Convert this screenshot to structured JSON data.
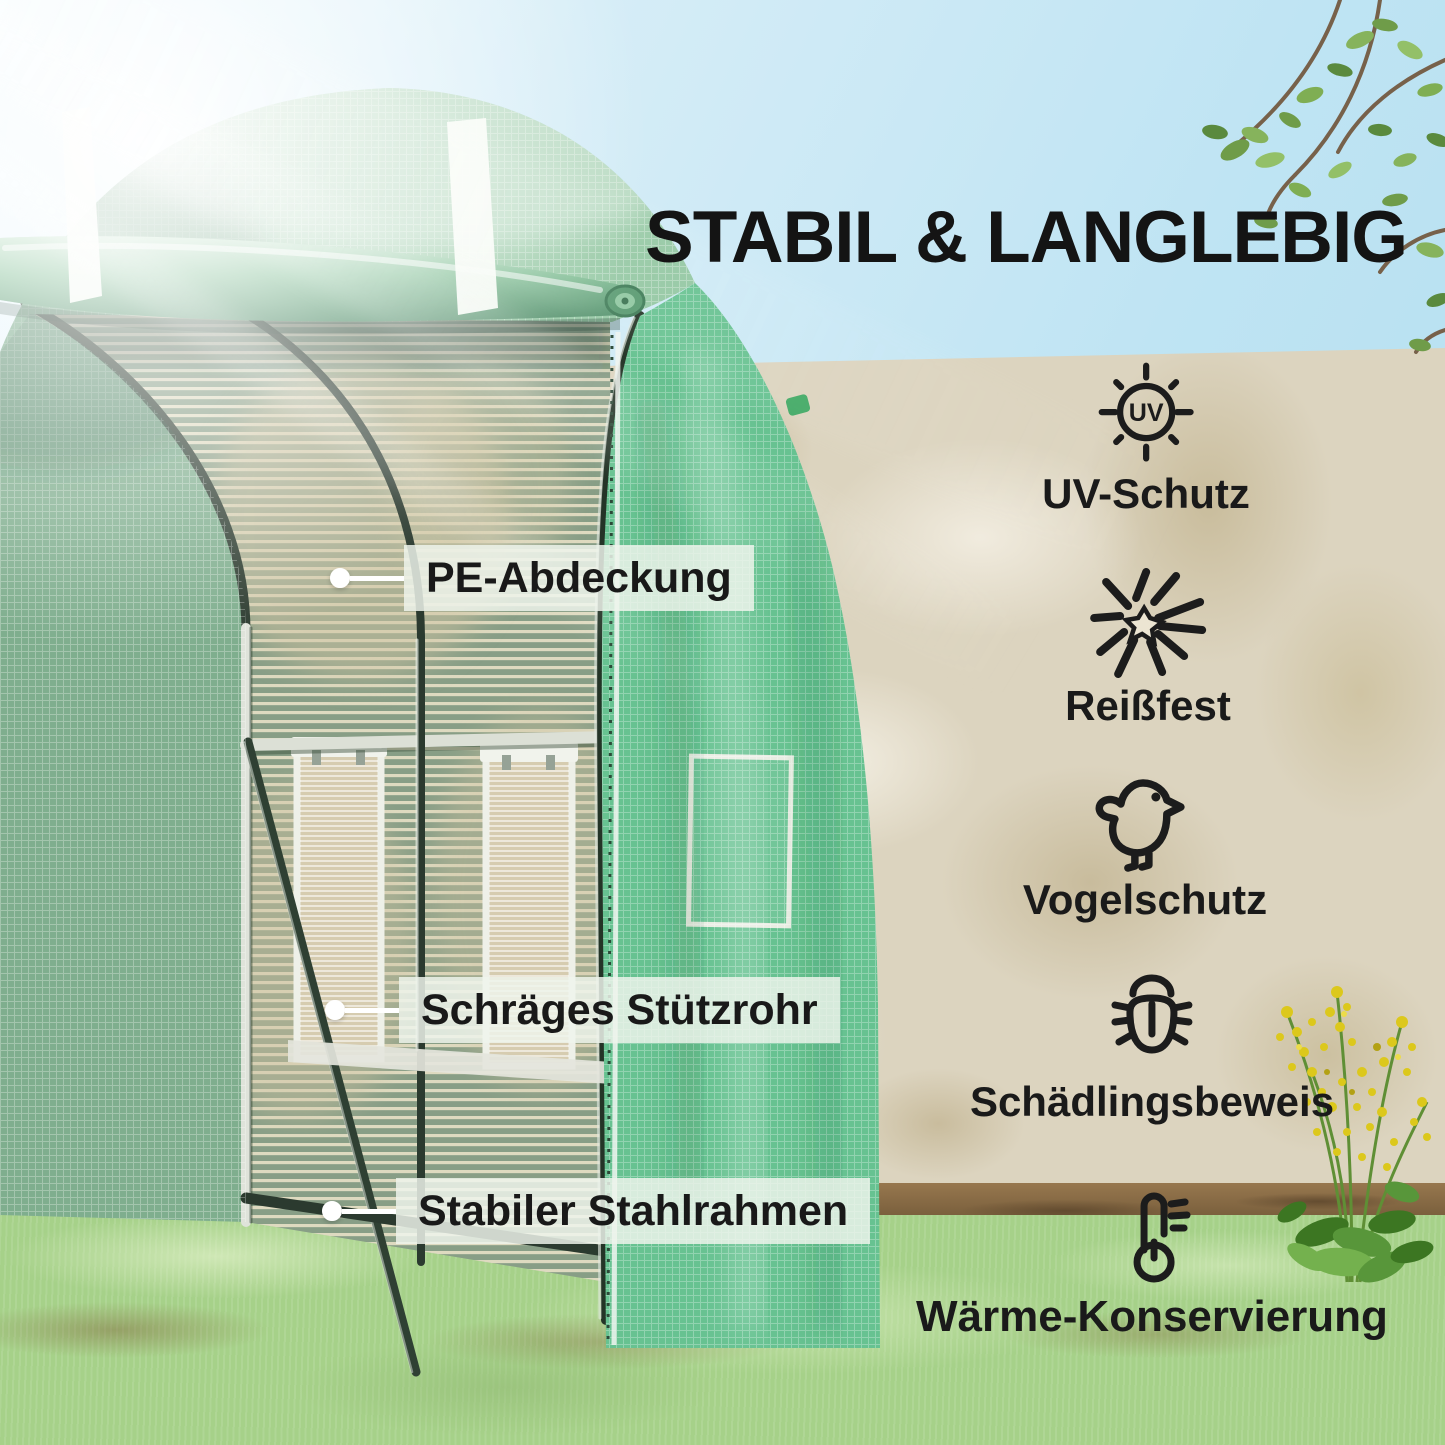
{
  "title": "STABIL & LANGLEBIG",
  "callouts": [
    {
      "id": "pe-cover",
      "label": "PE-Abdeckung"
    },
    {
      "id": "diagonal-support-tube",
      "label": "Schräges Stützrohr"
    },
    {
      "id": "steel-frame",
      "label": "Stabiler Stahlrahmen"
    }
  ],
  "features": [
    {
      "icon": "uv-sun-icon",
      "icon_text": "UV",
      "label": "UV-Schutz"
    },
    {
      "icon": "tear-resistant-icon",
      "label": "Reißfest"
    },
    {
      "icon": "bird-protection-icon",
      "label": "Vogelschutz"
    },
    {
      "icon": "pest-proof-bug-icon",
      "label": "Schädlingsbeweis"
    },
    {
      "icon": "heat-retention-thermometer-icon",
      "label": "Wärme-Konservierung"
    }
  ],
  "colors": {
    "greenhouse_green": "#67c291",
    "greenhouse_light_green": "#93c7a2",
    "frame_tube_dark": "#2b3a2f",
    "wall_beige": "#dcd4bf",
    "sky_blue": "#bfe4f3",
    "grass_green": "#a6d189",
    "flower_yellow": "#dcc81c",
    "label_background": "rgba(238,244,236,0.84)",
    "text_dark": "#1a1a1a"
  }
}
